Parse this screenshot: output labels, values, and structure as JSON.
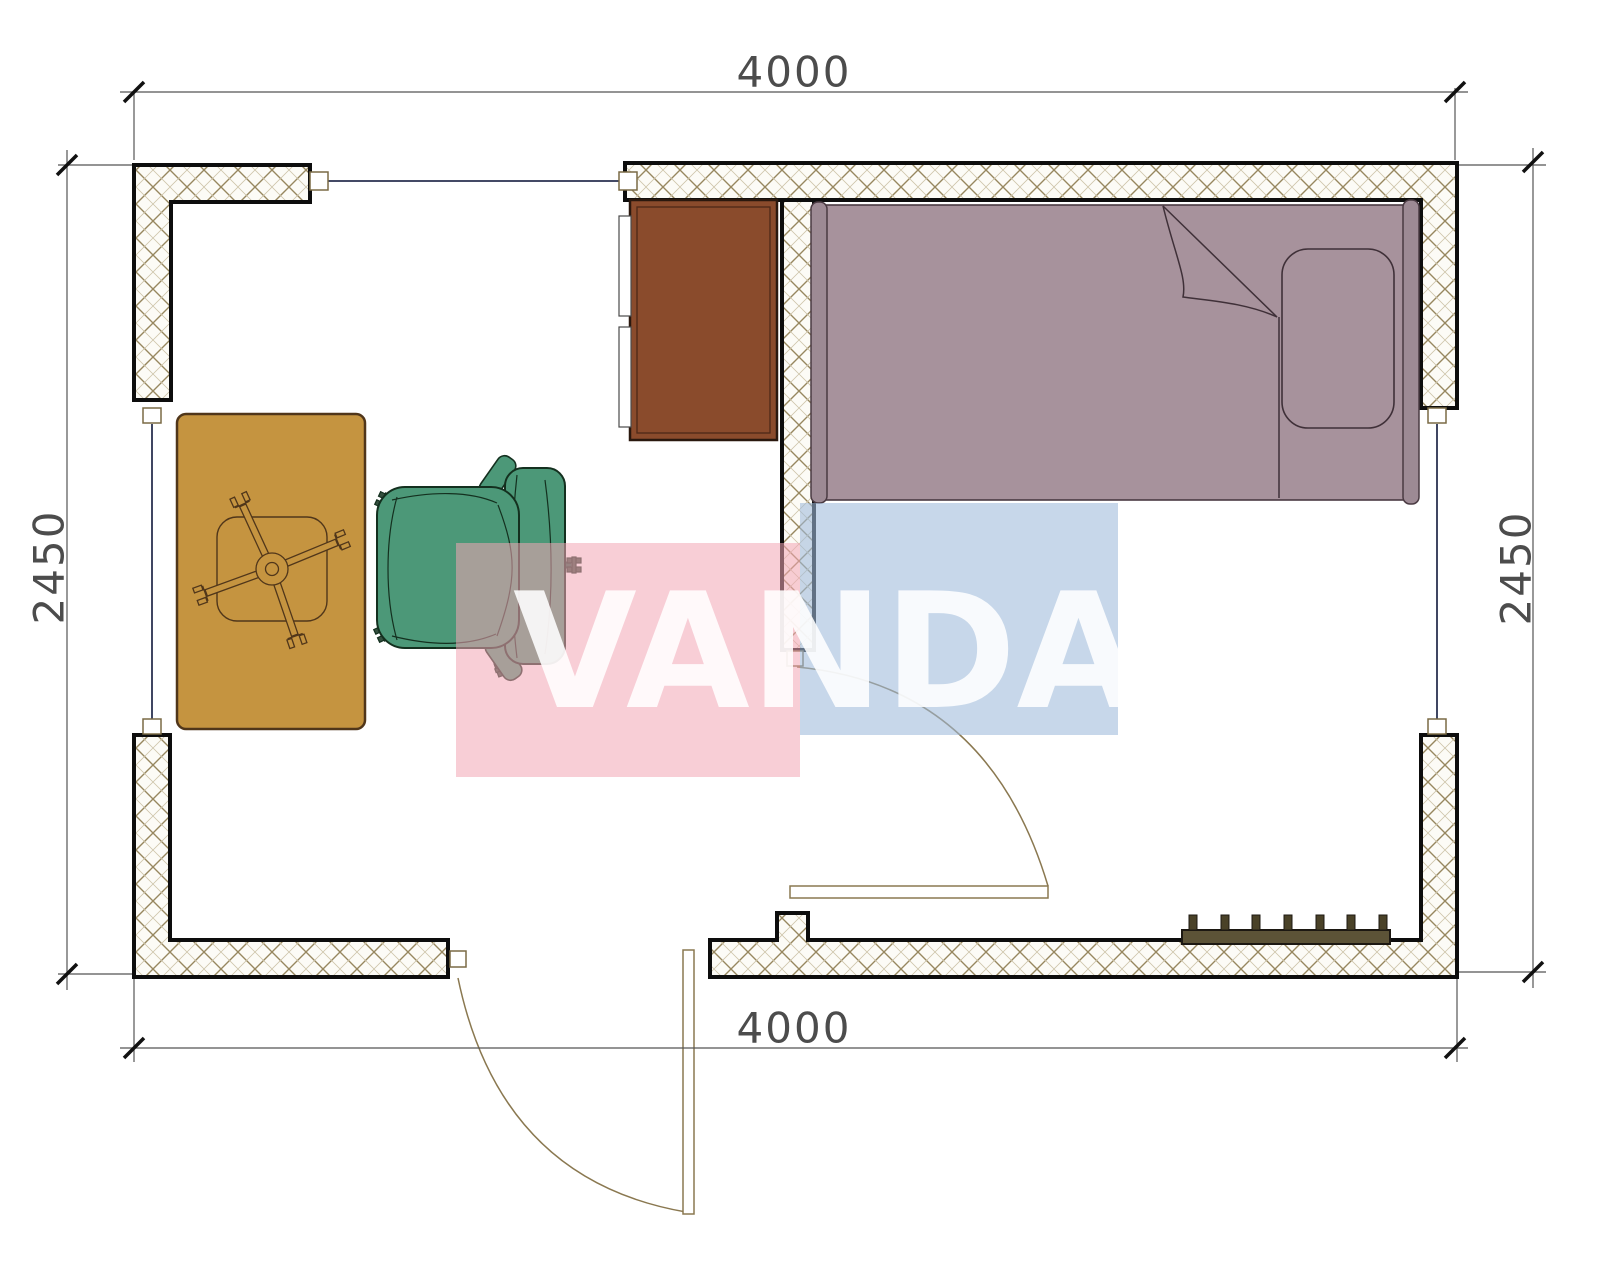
{
  "page": {
    "title": "Room floor plan"
  },
  "dimensions": {
    "top": {
      "label": "4000"
    },
    "bottom": {
      "label": "4000"
    },
    "left": {
      "label": "2450"
    },
    "right": {
      "label": "2450"
    }
  },
  "watermark": {
    "text": "VANDA",
    "pink_block_color": "#f2a6b4",
    "blue_block_color": "#9ebadb",
    "letter_color": "#ffffff"
  },
  "furniture": {
    "bed": {
      "color": "#a7929c"
    },
    "wardrobe": {
      "color": "#8a4b2c"
    },
    "table": {
      "color": "#c59440"
    },
    "office_chair": {
      "color": "#4c9878"
    },
    "radiator": {
      "color": "#5c5337"
    }
  },
  "plan": {
    "wall_hatch_color": "#97875f",
    "wall_outline_color": "#0d0d0d",
    "window_line_color": "#2a3150",
    "door_arc_color": "#8a7850",
    "dimension_color": "#4c4c4c"
  }
}
